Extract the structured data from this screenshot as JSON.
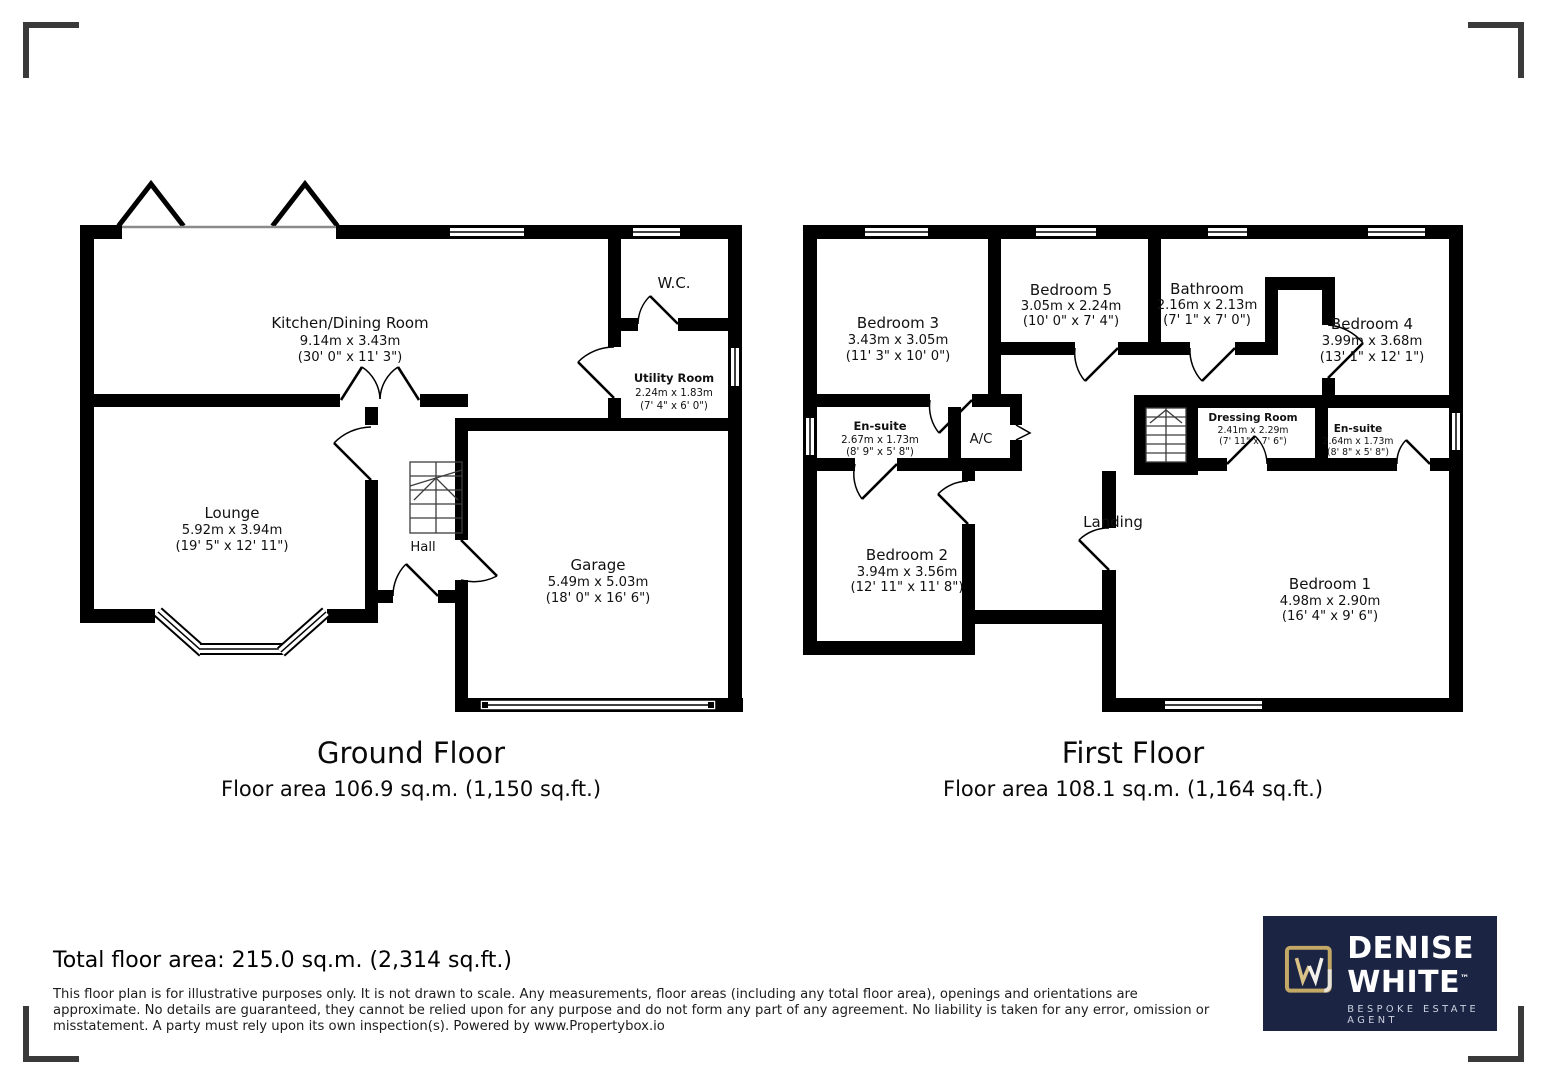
{
  "ground_floor": {
    "title": "Ground Floor",
    "area_label": "Floor area 106.9 sq.m. (1,150 sq.ft.)",
    "rooms": {
      "kitchen": {
        "name": "Kitchen/Dining Room",
        "metric": "9.14m x 3.43m",
        "imperial": "(30' 0\" x 11' 3\")"
      },
      "wc": {
        "name": "W.C."
      },
      "utility": {
        "name": "Utility Room",
        "metric": "2.24m x 1.83m",
        "imperial": "(7' 4\" x 6' 0\")"
      },
      "lounge": {
        "name": "Lounge",
        "metric": "5.92m x 3.94m",
        "imperial": "(19' 5\" x 12' 11\")"
      },
      "hall": {
        "name": "Hall"
      },
      "garage": {
        "name": "Garage",
        "metric": "5.49m x 5.03m",
        "imperial": "(18' 0\" x 16' 6\")"
      }
    }
  },
  "first_floor": {
    "title": "First Floor",
    "area_label": "Floor area 108.1 sq.m. (1,164 sq.ft.)",
    "rooms": {
      "bedroom3": {
        "name": "Bedroom 3",
        "metric": "3.43m x 3.05m",
        "imperial": "(11' 3\" x 10' 0\")"
      },
      "bedroom5": {
        "name": "Bedroom 5",
        "metric": "3.05m x 2.24m",
        "imperial": "(10' 0\" x 7' 4\")"
      },
      "bathroom": {
        "name": "Bathroom",
        "metric": "2.16m x 2.13m",
        "imperial": "(7' 1\" x 7' 0\")"
      },
      "bedroom4": {
        "name": "Bedroom 4",
        "metric": "3.99m x 3.68m",
        "imperial": "(13' 1\" x 12' 1\")"
      },
      "ensuite_left": {
        "name": "En-suite",
        "metric": "2.67m x 1.73m",
        "imperial": "(8' 9\" x 5' 8\")"
      },
      "ac": {
        "name": "A/C"
      },
      "dressing": {
        "name": "Dressing Room",
        "metric": "2.41m x 2.29m",
        "imperial": "(7' 11\" x 7' 6\")"
      },
      "ensuite_right": {
        "name": "En-suite",
        "metric": "2.64m x 1.73m",
        "imperial": "(8' 8\" x 5' 8\")"
      },
      "bedroom2": {
        "name": "Bedroom 2",
        "metric": "3.94m x 3.56m",
        "imperial": "(12' 11\" x 11' 8\")"
      },
      "landing": {
        "name": "Landing"
      },
      "bedroom1": {
        "name": "Bedroom 1",
        "metric": "4.98m x 2.90m",
        "imperial": "(16' 4\" x 9' 6\")"
      }
    }
  },
  "footer": {
    "total": "Total floor area: 215.0 sq.m. (2,314 sq.ft.)",
    "disclaimer": "This floor plan is for illustrative purposes only. It is not drawn to scale. Any measurements, floor areas (including any total floor area), openings and orientations are approximate. No details are guaranteed, they cannot be relied upon for any purpose and do not form any part of any agreement. No liability is taken for any error, omission or misstatement. A party must rely upon its own inspection(s). Powered by www.Propertybox.io"
  },
  "logo": {
    "line1": "DENISE",
    "line2": "WHITE",
    "tm": "™",
    "tagline": "BESPOKE ESTATE AGENT",
    "colors": {
      "panel": "#1c2444",
      "gold": "#c3a866",
      "text": "#ffffff"
    }
  }
}
